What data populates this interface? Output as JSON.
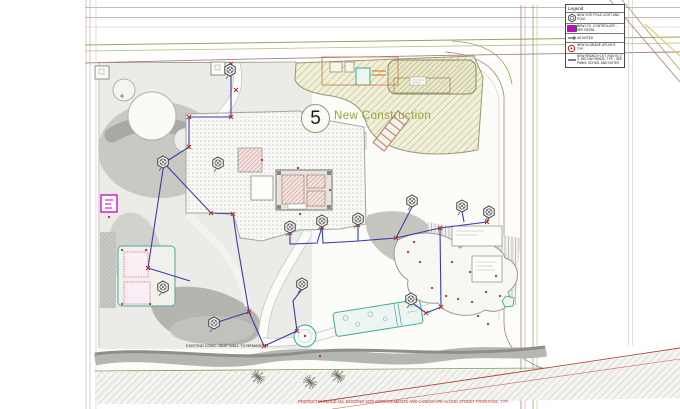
{
  "plan": {
    "area_number": "5",
    "area_label": "New Construction",
    "wall_note": "EXISTING CONC. SEAT WALL TO REMAIN - PROTECT IN PLACE",
    "street_note": "PROTECT IN PLACE ALL EXISTING SITE IMPROVEMENTS AND LANDSCAPE ALONG STREET FRONTAGE, TYP."
  },
  "legend": {
    "title": "Legend",
    "items": [
      {
        "icon": "pole-light-icon",
        "label": "NEW SITE POLE LIGHT AND POLE"
      },
      {
        "icon": "lighting-controller-icon",
        "label": "NEW LTG. CONTROLLER - SEE DETAIL"
      },
      {
        "icon": "conduit-stub-icon",
        "label": "AS NOTED"
      },
      {
        "icon": "in-grade-light-icon",
        "label": "NEW IN-GRADE UPLIGHT, TYP."
      },
      {
        "icon": "branch-circuit-icon",
        "label": "NEW BRANCH CKT. RUN IN 1\" C. BELOW GRADE, TYP. - SEE PANEL SCHED. AND NOTES"
      }
    ]
  },
  "colors": {
    "circuit_blue": "#3c3cae",
    "marker_red": "#c22a22",
    "controller_magenta": "#cc00cc",
    "construction_olive": "#9aa23c",
    "water_teal": "#3aa8a0",
    "road_maroon": "#a97e7e",
    "road_olive": "#9aa35c"
  }
}
